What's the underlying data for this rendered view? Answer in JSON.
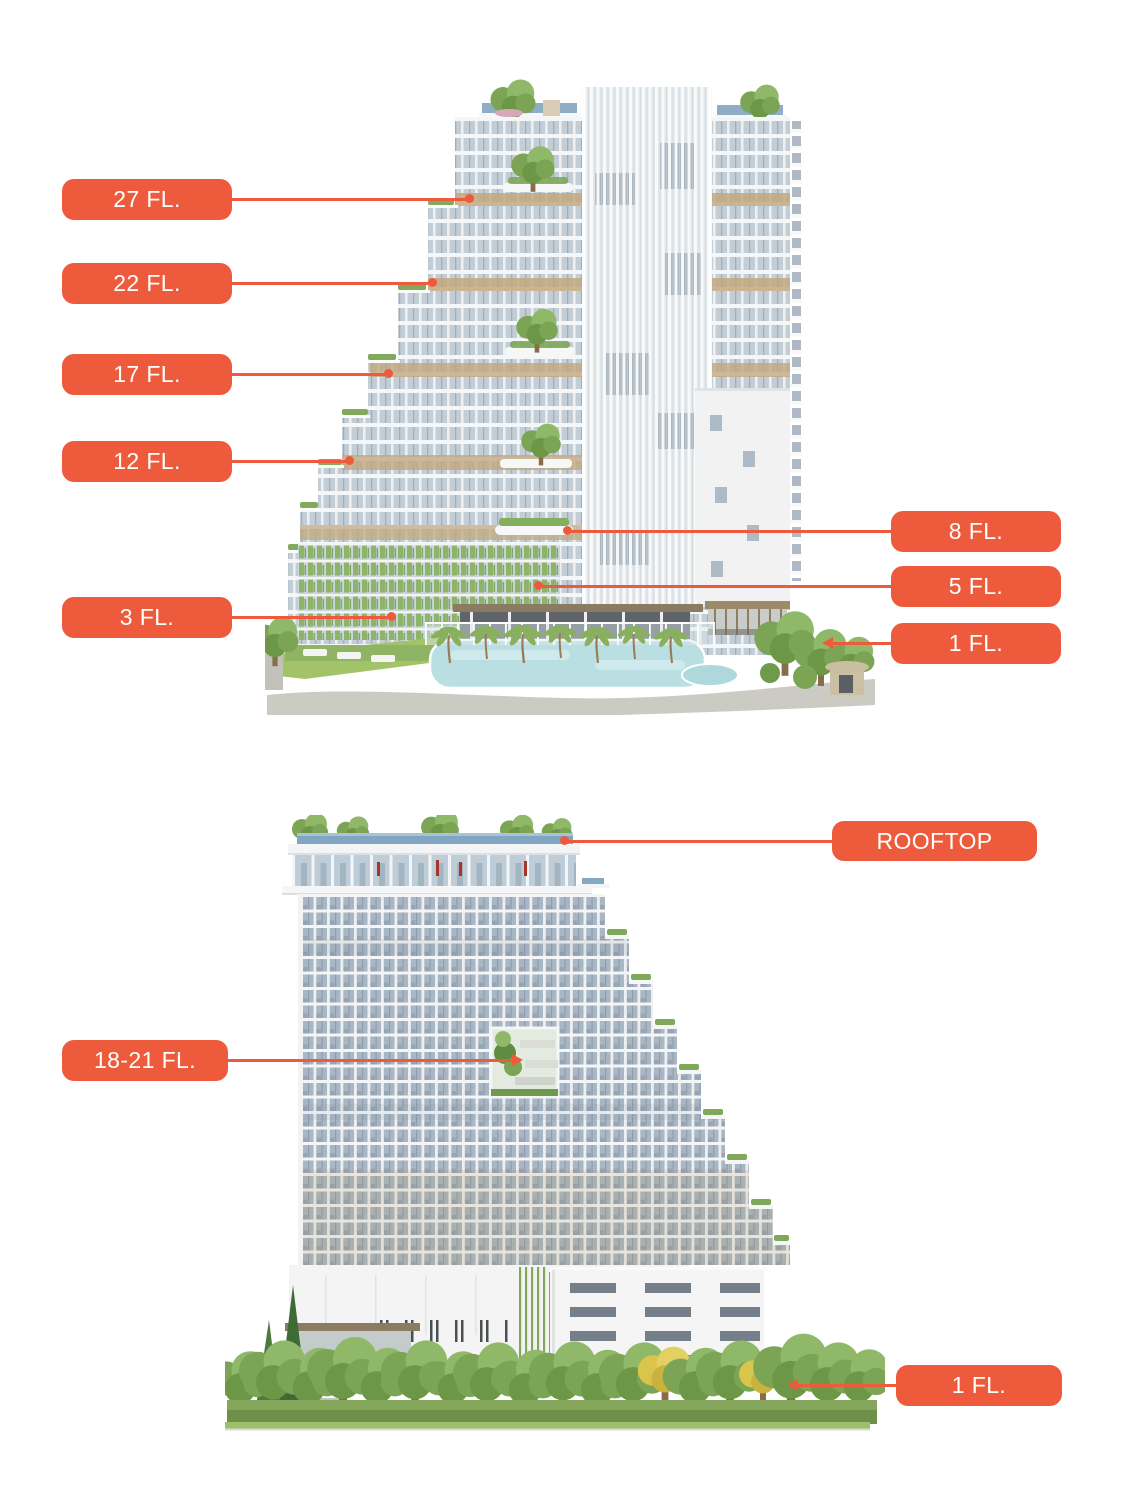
{
  "colors": {
    "accent": "#EE5B3C",
    "label_text": "#FFFFFF"
  },
  "labels": {
    "view1": {
      "fl27": "27 FL.",
      "fl22": "22 FL.",
      "fl17": "17 FL.",
      "fl12": "12 FL.",
      "fl3": "3 FL.",
      "fl8": "8 FL.",
      "fl5": "5 FL.",
      "fl1": "1 FL."
    },
    "view2": {
      "rooftop": "ROOFTOP",
      "fl18_21": "18-21 FL.",
      "fl1": "1 FL."
    }
  }
}
